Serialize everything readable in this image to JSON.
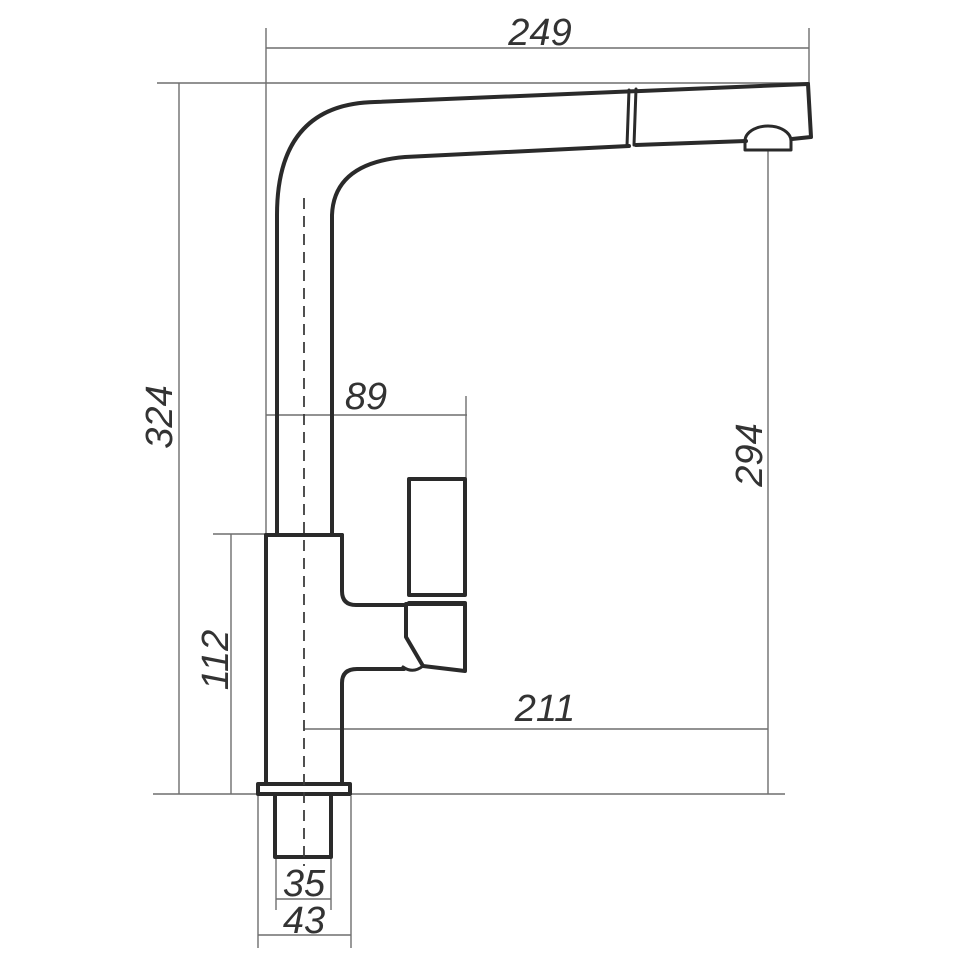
{
  "drawing": {
    "type": "technical-dimension-drawing",
    "dimensions": {
      "spout_reach": "249",
      "overall_height": "324",
      "handle_offset": "89",
      "outlet_height": "294",
      "body_height": "112",
      "outlet_reach": "211",
      "shank_width": "35",
      "base_width": "43"
    },
    "colors": {
      "outline": "#2a2a2a",
      "dimension_line": "#6e6e6e",
      "centerline": "#3c3c3c",
      "text": "#333333",
      "background": "#ffffff"
    }
  }
}
